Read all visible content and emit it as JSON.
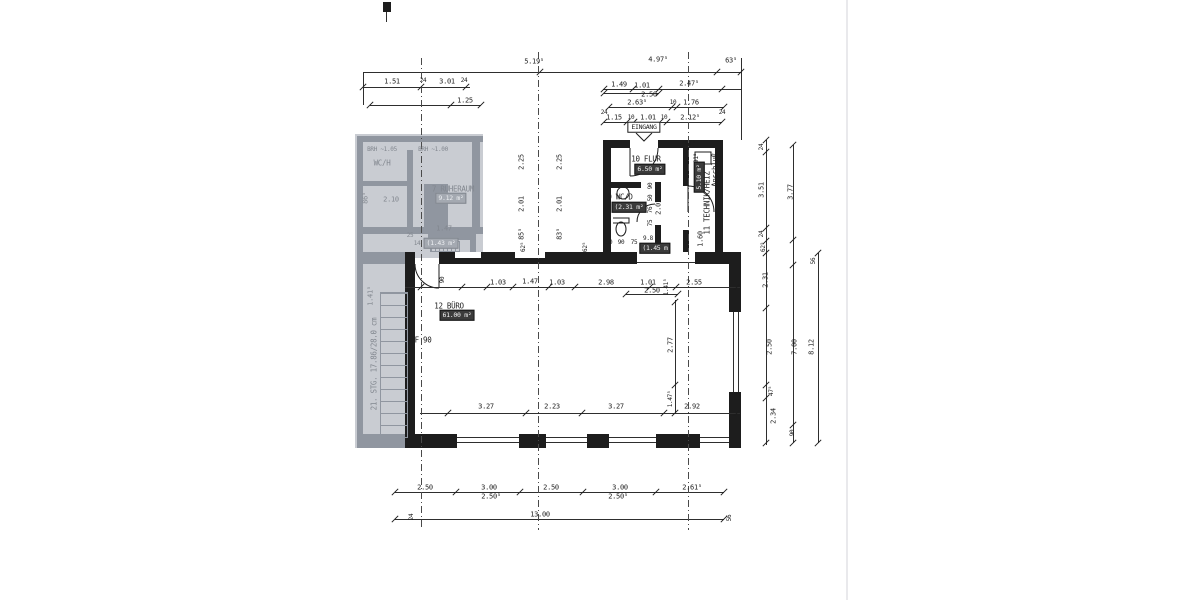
{
  "meta": {
    "type": "scanned architectural floor plan (German), ground-floor office unit",
    "entrance_label": "EINGANG",
    "fire_rating_label": "F 90",
    "stair_note": "21. STG. 17.86/28.0 cm",
    "overall_width_dim": "13.00",
    "colors": {
      "ink": "#1d1d1d",
      "paper": "#ffffff",
      "faded_bg": "#c9ccd2",
      "faded_ink": "#82878f",
      "box_bg": "#3b3b3b"
    }
  },
  "rooms": [
    {
      "number": "7",
      "name": "RUHERAUM",
      "area_label": "9.12 m²",
      "faded": true
    },
    {
      "number": "9",
      "name": "WC/D",
      "area_label": "(2.31 m²",
      "faded": false
    },
    {
      "number": "10",
      "name": "FLUR",
      "area_label": "6.50 m²",
      "faded": false
    },
    {
      "number": "11",
      "name": "TECHNIK/HEIZ",
      "area_label": "5.10 m²",
      "note": "Anschluß",
      "faded": false
    },
    {
      "number": "12",
      "name": "BÜRO",
      "area_label": "61.00 m²",
      "faded": false
    }
  ],
  "drawing": {
    "walls": [
      [
        355,
        134,
        128,
        124,
        "bg"
      ],
      [
        355,
        258,
        50,
        190,
        "bg"
      ],
      [
        357,
        136,
        126,
        6,
        "g"
      ],
      [
        357,
        136,
        6,
        122,
        "g"
      ],
      [
        357,
        181,
        56,
        5,
        "g"
      ],
      [
        424,
        184,
        24,
        48,
        "g"
      ],
      [
        407,
        150,
        6,
        82,
        "g"
      ],
      [
        357,
        227,
        126,
        7,
        "g"
      ],
      [
        472,
        136,
        8,
        96,
        "g"
      ],
      [
        428,
        234,
        46,
        6,
        "g"
      ],
      [
        470,
        234,
        6,
        24,
        "g"
      ],
      [
        357,
        252,
        48,
        12,
        "g"
      ],
      [
        357,
        434,
        48,
        14,
        "g"
      ],
      [
        357,
        258,
        6,
        176,
        "g"
      ],
      [
        430,
        241,
        28,
        9,
        "h"
      ],
      [
        383,
        2,
        8,
        10
      ],
      [
        603,
        140,
        27,
        8
      ],
      [
        658,
        140,
        65,
        8
      ],
      [
        603,
        140,
        8,
        112
      ],
      [
        715,
        140,
        8,
        112
      ],
      [
        683,
        148,
        6,
        38
      ],
      [
        683,
        230,
        6,
        22
      ],
      [
        611,
        182,
        30,
        6
      ],
      [
        655,
        182,
        6,
        20
      ],
      [
        655,
        225,
        6,
        27
      ],
      [
        405,
        252,
        10,
        12
      ],
      [
        439,
        252,
        198,
        12
      ],
      [
        695,
        252,
        46,
        12
      ],
      [
        405,
        264,
        10,
        170
      ],
      [
        405,
        434,
        52,
        14
      ],
      [
        519,
        434,
        27,
        14
      ],
      [
        587,
        434,
        22,
        14
      ],
      [
        656,
        434,
        44,
        14
      ],
      [
        729,
        434,
        12,
        14
      ],
      [
        729,
        252,
        12,
        60
      ],
      [
        729,
        392,
        12,
        42
      ],
      [
        455,
        252,
        26,
        6,
        "w"
      ],
      [
        515,
        252,
        30,
        6,
        "w"
      ]
    ],
    "stairs": {
      "x": 380,
      "y": 292,
      "w": 26,
      "h": 144
    },
    "lines": [
      [
        363,
        72,
        379,
        1
      ],
      [
        363,
        72,
        1,
        33
      ],
      [
        741,
        58,
        1,
        82
      ],
      [
        363,
        87,
        107,
        1
      ],
      [
        370,
        105,
        111,
        1
      ],
      [
        603,
        89,
        138,
        1
      ],
      [
        604,
        93,
        55,
        1
      ],
      [
        609,
        107,
        115,
        1
      ],
      [
        604,
        122,
        118,
        1
      ],
      [
        405,
        287,
        335,
        1
      ],
      [
        626,
        294,
        52,
        1
      ],
      [
        420,
        413,
        320,
        1
      ],
      [
        675,
        300,
        1,
        113
      ],
      [
        766,
        140,
        1,
        305
      ],
      [
        793,
        145,
        1,
        298
      ],
      [
        818,
        253,
        1,
        190
      ],
      [
        395,
        492,
        329,
        1
      ],
      [
        395,
        519,
        329,
        1
      ],
      [
        457,
        437,
        62,
        1
      ],
      [
        457,
        442,
        62,
        1
      ],
      [
        546,
        437,
        41,
        1
      ],
      [
        546,
        442,
        41,
        1
      ],
      [
        609,
        437,
        47,
        1
      ],
      [
        609,
        442,
        47,
        1
      ],
      [
        700,
        437,
        29,
        1
      ],
      [
        700,
        442,
        29,
        1
      ],
      [
        733,
        312,
        1,
        80
      ],
      [
        738,
        312,
        1,
        80
      ],
      [
        637,
        262,
        58,
        1
      ],
      [
        386,
        12,
        1,
        10
      ],
      [
        421,
        58,
        1,
        472,
        "d"
      ],
      [
        538,
        52,
        1,
        478,
        "d"
      ],
      [
        688,
        52,
        1,
        478,
        "d"
      ],
      [
        846,
        0,
        2,
        600,
        "f"
      ]
    ],
    "ticks": [
      [
        540,
        72
      ],
      [
        717,
        72
      ],
      [
        741,
        72
      ],
      [
        363,
        87
      ],
      [
        421,
        87
      ],
      [
        466,
        87
      ],
      [
        370,
        105
      ],
      [
        451,
        105
      ],
      [
        481,
        105
      ],
      [
        604,
        89
      ],
      [
        633,
        89
      ],
      [
        659,
        89
      ],
      [
        722,
        89
      ],
      [
        604,
        93
      ],
      [
        659,
        93
      ],
      [
        609,
        107
      ],
      [
        672,
        107
      ],
      [
        677,
        107
      ],
      [
        724,
        107
      ],
      [
        604,
        122
      ],
      [
        627,
        122
      ],
      [
        634,
        122
      ],
      [
        660,
        122
      ],
      [
        667,
        122
      ],
      [
        722,
        122
      ],
      [
        421,
        287
      ],
      [
        462,
        287
      ],
      [
        487,
        287
      ],
      [
        513,
        287
      ],
      [
        549,
        287
      ],
      [
        575,
        287
      ],
      [
        650,
        287
      ],
      [
        676,
        287
      ],
      [
        737,
        287
      ],
      [
        626,
        294
      ],
      [
        678,
        294
      ],
      [
        448,
        413
      ],
      [
        526,
        413
      ],
      [
        582,
        413
      ],
      [
        664,
        413
      ],
      [
        737,
        413
      ],
      [
        675,
        302
      ],
      [
        675,
        385
      ],
      [
        675,
        413
      ],
      [
        766,
        140
      ],
      [
        766,
        152
      ],
      [
        766,
        228
      ],
      [
        766,
        241
      ],
      [
        766,
        253
      ],
      [
        766,
        308
      ],
      [
        766,
        385
      ],
      [
        766,
        398
      ],
      [
        766,
        443
      ],
      [
        793,
        145
      ],
      [
        793,
        240
      ],
      [
        793,
        265
      ],
      [
        793,
        425
      ],
      [
        793,
        443
      ],
      [
        818,
        253
      ],
      [
        818,
        443
      ],
      [
        395,
        492
      ],
      [
        456,
        492
      ],
      [
        520,
        492
      ],
      [
        583,
        492
      ],
      [
        656,
        492
      ],
      [
        724,
        492
      ],
      [
        395,
        519
      ],
      [
        724,
        519
      ]
    ],
    "paths": [
      {
        "d": "M658,148 A28 28 0 0 1 630,176",
        "n": "door-arc"
      },
      {
        "d": "M630,148 L630,176",
        "n": "door-leaf"
      },
      {
        "d": "M688,186 A26 26 0 0 1 714,212",
        "n": "door-arc"
      },
      {
        "d": "M688,186 L688,212",
        "n": "door-leaf"
      },
      {
        "d": "M655,204 A18 18 0 0 0 637,222",
        "n": "door-arc"
      },
      {
        "d": "M415,264 A24 24 0 0 0 439,288",
        "n": "door-arc"
      },
      {
        "d": "M439,264 L439,288",
        "n": "door-leaf"
      },
      {
        "d": "M617,193 a6 6 0 1 0 12 0 a6 6 0 1 0 -12 0",
        "n": "sink-icon"
      },
      {
        "d": "M616,229 a5 7 0 1 0 10 0 a5 7 0 1 0 -10 0",
        "n": "toilet-icon"
      },
      {
        "d": "M613,218 h16 v5 h-16",
        "n": "toilet-icon"
      },
      {
        "d": "M695,152 h16 v12 h-16 z",
        "n": "boiler-icon"
      },
      {
        "d": "M636,133 L644,141 L652,133",
        "n": "entrance-arrow-icon"
      },
      {
        "d": "M365,288 A26 26 0 0 1 391,262",
        "n": "door-arc",
        "g": 1
      },
      {
        "d": "M382,434 L404,294",
        "n": "stair-run-line",
        "g": 1
      },
      {
        "d": "M361,157 a7 7 0 1 0 14 0 a7 7 0 1 0 -14 0",
        "n": "sink-icon",
        "g": 1
      }
    ],
    "labels": [
      [
        534,
        62,
        "5.19⁵",
        "d"
      ],
      [
        658,
        60,
        "4.97⁵",
        "d"
      ],
      [
        731,
        61,
        "63⁵",
        "d"
      ],
      [
        392,
        82,
        "1.51",
        "d"
      ],
      [
        447,
        82,
        "3.01",
        "d"
      ],
      [
        423,
        81,
        "24",
        "ds"
      ],
      [
        464,
        81,
        "24",
        "ds"
      ],
      [
        465,
        101,
        "1.25",
        "d"
      ],
      [
        619,
        85,
        "1.49",
        "d"
      ],
      [
        642,
        86,
        "1.01",
        "d"
      ],
      [
        689,
        84,
        "2.47⁵",
        "d"
      ],
      [
        649,
        95,
        "2.50",
        "d"
      ],
      [
        637,
        103,
        "2.63⁵",
        "d"
      ],
      [
        691,
        103,
        "1.76",
        "d"
      ],
      [
        673,
        103,
        "10",
        "ds"
      ],
      [
        614,
        118,
        "1.15",
        "d"
      ],
      [
        648,
        118,
        "1.01",
        "d"
      ],
      [
        690,
        118,
        "2.12⁵",
        "d"
      ],
      [
        631,
        118,
        "10",
        "ds"
      ],
      [
        664,
        118,
        "10",
        "ds"
      ],
      [
        604,
        113,
        "24",
        "ds"
      ],
      [
        722,
        113,
        "24",
        "ds"
      ],
      [
        644,
        127,
        "EINGANG",
        "e"
      ],
      [
        646,
        159,
        "10 FLUR",
        "r"
      ],
      [
        650,
        169,
        "6.50 m²",
        "b"
      ],
      [
        620,
        197,
        "9 WC/D",
        "r"
      ],
      [
        629,
        207,
        "(2.31 m²",
        "b"
      ],
      [
        715,
        170,
        "Anschluß",
        "rv"
      ],
      [
        707,
        203,
        "11 TECHNIK/HEIZ",
        "rv"
      ],
      [
        699,
        177,
        "5.10 m²",
        "bv"
      ],
      [
        648,
        239,
        "9.8",
        "ds"
      ],
      [
        655,
        248,
        "(1.45 m",
        "b"
      ],
      [
        609,
        243,
        "50",
        "ds"
      ],
      [
        621,
        243,
        "90",
        "ds"
      ],
      [
        634,
        243,
        "75",
        "ds"
      ],
      [
        718,
        243,
        "50",
        "ds"
      ],
      [
        651,
        186,
        "90",
        "vs"
      ],
      [
        651,
        198,
        "50",
        "vs"
      ],
      [
        651,
        210,
        "76",
        "vs"
      ],
      [
        659,
        207,
        "2.01",
        "v"
      ],
      [
        651,
        223,
        "75",
        "vs"
      ],
      [
        701,
        239,
        "1.60",
        "v"
      ],
      [
        690,
        144,
        "67⁵",
        "ds"
      ],
      [
        697,
        158,
        "91⁵",
        "vs"
      ],
      [
        522,
        162,
        "2.25",
        "v"
      ],
      [
        522,
        204,
        "2.01",
        "v"
      ],
      [
        522,
        234,
        "85⁵",
        "v"
      ],
      [
        560,
        162,
        "2.25",
        "v"
      ],
      [
        560,
        204,
        "2.01",
        "v"
      ],
      [
        560,
        234,
        "83⁵",
        "v"
      ],
      [
        524,
        247,
        "62⁵",
        "vs"
      ],
      [
        586,
        247,
        "62⁵",
        "vs"
      ],
      [
        449,
        306,
        "12 BÜRO",
        "r"
      ],
      [
        457,
        315,
        "61.00 m²",
        "b"
      ],
      [
        423,
        340,
        "F 90",
        "r"
      ],
      [
        410,
        281,
        ".68",
        "ds"
      ],
      [
        443,
        280,
        "90",
        "vs"
      ],
      [
        498,
        283,
        "1.03",
        "d"
      ],
      [
        530,
        282,
        "1.47",
        "d"
      ],
      [
        557,
        283,
        "1.03",
        "d"
      ],
      [
        606,
        283,
        "2.98",
        "d"
      ],
      [
        648,
        283,
        "1.01",
        "d"
      ],
      [
        652,
        291,
        "2.50",
        "d"
      ],
      [
        694,
        283,
        "2.55",
        "d"
      ],
      [
        667,
        287,
        "1.41⁵",
        "vs"
      ],
      [
        671,
        345,
        "2.77",
        "v"
      ],
      [
        671,
        399,
        "1.47⁵",
        "vs"
      ],
      [
        486,
        407,
        "3.27",
        "d"
      ],
      [
        552,
        407,
        "2.23",
        "d"
      ],
      [
        616,
        407,
        "3.27",
        "d"
      ],
      [
        692,
        407,
        "2.92",
        "d"
      ],
      [
        762,
        147,
        "24",
        "vs"
      ],
      [
        762,
        190,
        "3.51",
        "v"
      ],
      [
        762,
        234,
        "24",
        "vs"
      ],
      [
        764,
        247,
        "62⁵",
        "vs"
      ],
      [
        766,
        280,
        "2.31",
        "v"
      ],
      [
        770,
        347,
        "2.50",
        "v"
      ],
      [
        772,
        391,
        "47⁵",
        "vs"
      ],
      [
        774,
        416,
        "2.34",
        "v"
      ],
      [
        791,
        192,
        "3.77",
        "v"
      ],
      [
        795,
        347,
        "7.00",
        "v"
      ],
      [
        793,
        433,
        "90",
        "vs"
      ],
      [
        814,
        261,
        "56",
        "vs"
      ],
      [
        812,
        347,
        "8.12",
        "v"
      ],
      [
        425,
        488,
        "2.50",
        "d"
      ],
      [
        489,
        488,
        "3.00",
        "d"
      ],
      [
        551,
        488,
        "2.50",
        "d"
      ],
      [
        620,
        488,
        "3.00",
        "d"
      ],
      [
        692,
        488,
        "2.61⁵",
        "d"
      ],
      [
        491,
        497,
        "2.50⁵",
        "d"
      ],
      [
        618,
        497,
        "2.50⁵",
        "d"
      ],
      [
        540,
        515,
        "13.00",
        "d"
      ],
      [
        412,
        517,
        "24",
        "vs"
      ],
      [
        730,
        518,
        "56",
        "vs"
      ],
      [
        382,
        150,
        "BRH ~1.05",
        "gds"
      ],
      [
        433,
        150,
        "BRH ~1.00",
        "gds"
      ],
      [
        382,
        163,
        "WC/H",
        "gr"
      ],
      [
        453,
        189,
        "7 RUHERAUM",
        "gr"
      ],
      [
        451,
        198,
        "9.12 m²",
        "gb"
      ],
      [
        441,
        243,
        "(1.43 m²",
        "gb"
      ],
      [
        366,
        198,
        "86⁵",
        "gv"
      ],
      [
        391,
        200,
        "2.10",
        "gd"
      ],
      [
        444,
        229,
        "1.47",
        "gd"
      ],
      [
        410,
        236,
        "25",
        "gds"
      ],
      [
        417,
        244,
        "14",
        "gds"
      ],
      [
        371,
        296,
        "1.41⁵",
        "gv"
      ],
      [
        374,
        364,
        "21. STG. 17.86/28.0 cm",
        "grv"
      ]
    ]
  }
}
